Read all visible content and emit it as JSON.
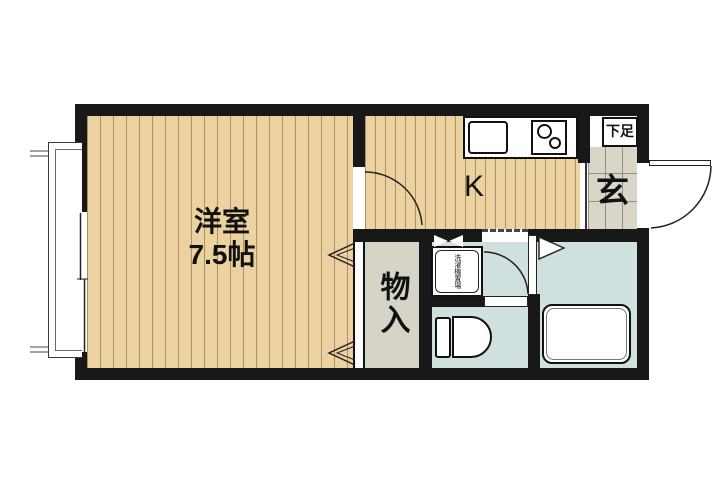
{
  "plan": {
    "western_room": {
      "name": "洋室",
      "size": "7.5帖"
    },
    "kitchen": {
      "label": "K"
    },
    "entrance": {
      "label": "玄"
    },
    "shoe_cabinet": {
      "label": "下足"
    },
    "storage": {
      "label": "物入"
    },
    "washing_machine": {
      "label": "洗濯機置場"
    }
  },
  "colors": {
    "wall": "#181818",
    "wood_floor": "#ecd1a1",
    "wood_stripe": "#7a5c30",
    "wet_floor": "#cfe0df",
    "storage_floor": "#d6d3c7",
    "tile_floor": "#d9d6c9",
    "tile_line": "#8f8f83",
    "fixture_outline": "#111111"
  }
}
